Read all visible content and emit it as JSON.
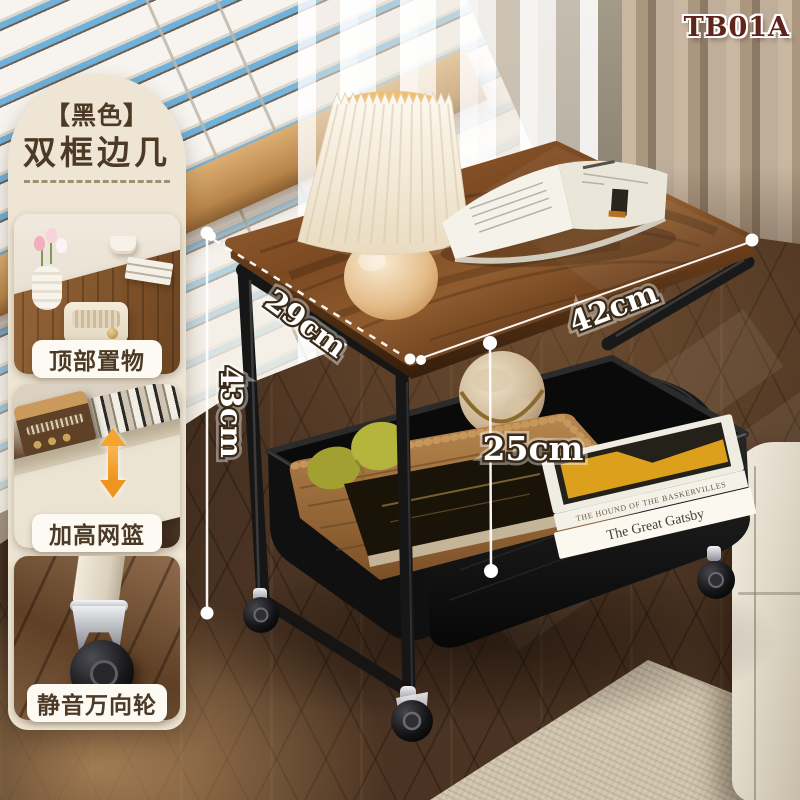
{
  "model_label": "TB01A",
  "panel": {
    "title_badge": "【黑色】",
    "title": "双框边几",
    "features": [
      {
        "caption": "顶部置物"
      },
      {
        "caption": "加高网篮"
      },
      {
        "caption": "静音万向轮"
      }
    ]
  },
  "dimensions": {
    "depth": "29cm",
    "width": "42cm",
    "height": "43cm",
    "clearance": "25cm"
  },
  "props": {
    "book_spine_1": "The Great Gatsby",
    "book_spine_2": "THE HOUND OF THE BASKERVILLES"
  },
  "colors": {
    "panel_bg": "#eee5d4",
    "panel_text": "#4c3a26",
    "model_text": "#5f241b",
    "annotation_fill": "#ffffff",
    "annotation_outline": "#3a2a18",
    "arrow_accent": "#f5a52f",
    "frame_black": "#161616",
    "wood_top": "#8a5530"
  }
}
